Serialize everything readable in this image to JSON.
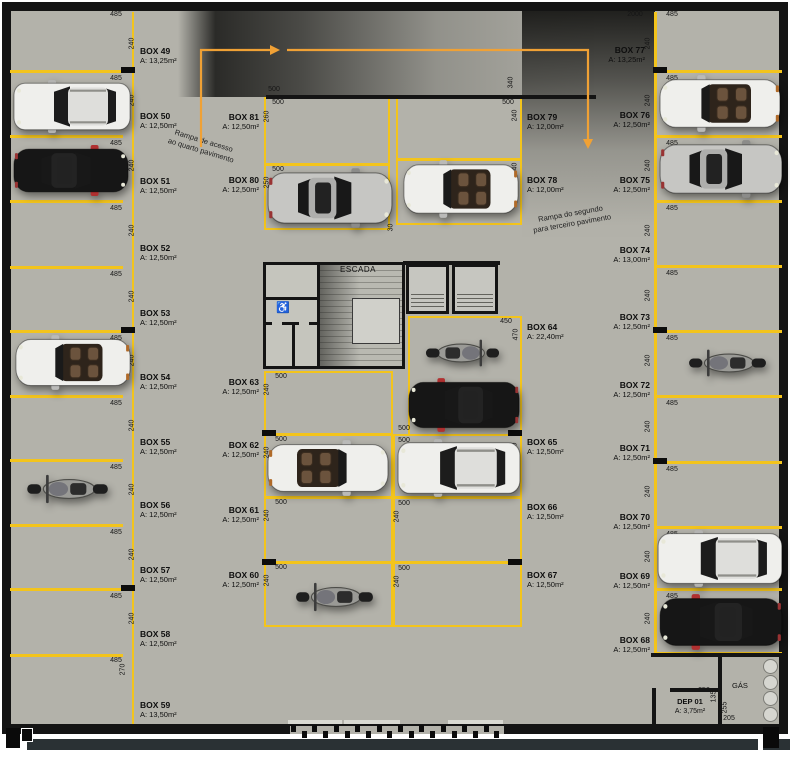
{
  "colors": {
    "floor": "#b3b2aa",
    "yellow": "#f3c41c",
    "wall": "#141414",
    "orange": "#f0a135",
    "strip": "#2a3134"
  },
  "rooms": {
    "escada": "ESCADA",
    "gas": "GÁS",
    "dep_name": "DEP 01",
    "dep_area": "A: 3,75m²"
  },
  "icons": {
    "wheelchair": "♿"
  },
  "annotations": [
    {
      "text": "Rampa de acesso",
      "line2": "ao quarto pavimento",
      "x": 168,
      "y": 136,
      "rot": 17
    },
    {
      "text": "Rampa do segundo",
      "line2": "para terceiro pavimento",
      "x": 532,
      "y": 209,
      "rot": -10
    }
  ],
  "boxes": [
    {
      "label": "BOX 49",
      "area": "A: 13,25m²",
      "x": 140,
      "y": 46,
      "align": "left"
    },
    {
      "label": "BOX 50",
      "area": "A: 12,50m²",
      "x": 140,
      "y": 111,
      "align": "left"
    },
    {
      "label": "BOX 51",
      "area": "A: 12,50m²",
      "x": 140,
      "y": 176,
      "align": "left"
    },
    {
      "label": "BOX 52",
      "area": "A: 12,50m²",
      "x": 140,
      "y": 243,
      "align": "left"
    },
    {
      "label": "BOX 53",
      "area": "A: 12,50m²",
      "x": 140,
      "y": 308,
      "align": "left"
    },
    {
      "label": "BOX 54",
      "area": "A: 12,50m²",
      "x": 140,
      "y": 372,
      "align": "left"
    },
    {
      "label": "BOX 55",
      "area": "A: 12,50m²",
      "x": 140,
      "y": 437,
      "align": "left"
    },
    {
      "label": "BOX 56",
      "area": "A: 12,50m²",
      "x": 140,
      "y": 500,
      "align": "left"
    },
    {
      "label": "BOX 57",
      "area": "A: 12,50m²",
      "x": 140,
      "y": 565,
      "align": "left"
    },
    {
      "label": "BOX 58",
      "area": "A: 12,50m²",
      "x": 140,
      "y": 629,
      "align": "left"
    },
    {
      "label": "BOX 59",
      "area": "A: 13,50m²",
      "x": 140,
      "y": 700,
      "align": "left"
    },
    {
      "label": "BOX 60",
      "area": "A: 12,50m²",
      "x": 259,
      "y": 570,
      "align": "right"
    },
    {
      "label": "BOX 61",
      "area": "A: 12,50m²",
      "x": 259,
      "y": 505,
      "align": "right"
    },
    {
      "label": "BOX 62",
      "area": "A: 12,50m²",
      "x": 259,
      "y": 440,
      "align": "right"
    },
    {
      "label": "BOX 63",
      "area": "A: 12,50m²",
      "x": 259,
      "y": 377,
      "align": "right"
    },
    {
      "label": "BOX 64",
      "area": "A: 22,40m²",
      "x": 527,
      "y": 322,
      "align": "left"
    },
    {
      "label": "BOX 65",
      "area": "A: 12,50m²",
      "x": 527,
      "y": 437,
      "align": "left"
    },
    {
      "label": "BOX 66",
      "area": "A: 12,50m²",
      "x": 527,
      "y": 502,
      "align": "left"
    },
    {
      "label": "BOX 67",
      "area": "A: 12,50m²",
      "x": 527,
      "y": 570,
      "align": "left"
    },
    {
      "label": "BOX 68",
      "area": "A: 12,50m²",
      "x": 650,
      "y": 635,
      "align": "right"
    },
    {
      "label": "BOX 69",
      "area": "A: 12,50m²",
      "x": 650,
      "y": 571,
      "align": "right"
    },
    {
      "label": "BOX 70",
      "area": "A: 12,50m²",
      "x": 650,
      "y": 512,
      "align": "right"
    },
    {
      "label": "BOX 71",
      "area": "A: 12,50m²",
      "x": 650,
      "y": 443,
      "align": "right"
    },
    {
      "label": "BOX 72",
      "area": "A: 12,50m²",
      "x": 650,
      "y": 380,
      "align": "right"
    },
    {
      "label": "BOX 73",
      "area": "A: 12,50m²",
      "x": 650,
      "y": 312,
      "align": "right"
    },
    {
      "label": "BOX 74",
      "area": "A: 13,00m²",
      "x": 650,
      "y": 245,
      "align": "right"
    },
    {
      "label": "BOX 75",
      "area": "A: 12,50m²",
      "x": 650,
      "y": 175,
      "align": "right"
    },
    {
      "label": "BOX 76",
      "area": "A: 12,50m²",
      "x": 650,
      "y": 110,
      "align": "right"
    },
    {
      "label": "BOX 77",
      "area": "A: 13,25m²",
      "x": 645,
      "y": 45,
      "align": "right"
    },
    {
      "label": "BOX 78",
      "area": "A: 12,00m²",
      "x": 527,
      "y": 175,
      "align": "left"
    },
    {
      "label": "BOX 79",
      "area": "A: 12,00m²",
      "x": 527,
      "y": 112,
      "align": "left"
    },
    {
      "label": "BOX 80",
      "area": "A: 12,50m²",
      "x": 259,
      "y": 175,
      "align": "right"
    },
    {
      "label": "BOX 81",
      "area": "A: 12,50m²",
      "x": 259,
      "y": 112,
      "align": "right"
    }
  ],
  "dims": [
    {
      "t": "485",
      "x": 116,
      "y": 15
    },
    {
      "t": "485",
      "x": 116,
      "y": 79
    },
    {
      "t": "485",
      "x": 116,
      "y": 144
    },
    {
      "t": "485",
      "x": 116,
      "y": 209
    },
    {
      "t": "485",
      "x": 116,
      "y": 275
    },
    {
      "t": "485",
      "x": 116,
      "y": 339
    },
    {
      "t": "485",
      "x": 116,
      "y": 404
    },
    {
      "t": "485",
      "x": 116,
      "y": 468
    },
    {
      "t": "485",
      "x": 116,
      "y": 533
    },
    {
      "t": "485",
      "x": 116,
      "y": 597
    },
    {
      "t": "485",
      "x": 116,
      "y": 661
    },
    {
      "t": "240",
      "x": 132,
      "y": 44,
      "r": 1
    },
    {
      "t": "240",
      "x": 132,
      "y": 101,
      "r": 1
    },
    {
      "t": "240",
      "x": 132,
      "y": 166,
      "r": 1
    },
    {
      "t": "240",
      "x": 132,
      "y": 231,
      "r": 1
    },
    {
      "t": "240",
      "x": 132,
      "y": 297,
      "r": 1
    },
    {
      "t": "240",
      "x": 132,
      "y": 361,
      "r": 1
    },
    {
      "t": "240",
      "x": 132,
      "y": 426,
      "r": 1
    },
    {
      "t": "240",
      "x": 132,
      "y": 490,
      "r": 1
    },
    {
      "t": "240",
      "x": 132,
      "y": 555,
      "r": 1
    },
    {
      "t": "240",
      "x": 132,
      "y": 619,
      "r": 1
    },
    {
      "t": "270",
      "x": 123,
      "y": 670,
      "r": 1
    },
    {
      "t": "485",
      "x": 672,
      "y": 15
    },
    {
      "t": "485",
      "x": 672,
      "y": 79
    },
    {
      "t": "485",
      "x": 672,
      "y": 144
    },
    {
      "t": "485",
      "x": 672,
      "y": 209
    },
    {
      "t": "485",
      "x": 672,
      "y": 274
    },
    {
      "t": "485",
      "x": 672,
      "y": 339
    },
    {
      "t": "485",
      "x": 672,
      "y": 404
    },
    {
      "t": "485",
      "x": 672,
      "y": 470
    },
    {
      "t": "485",
      "x": 672,
      "y": 535
    },
    {
      "t": "485",
      "x": 672,
      "y": 597
    },
    {
      "t": "240",
      "x": 648,
      "y": 44,
      "r": 1
    },
    {
      "t": "240",
      "x": 648,
      "y": 101,
      "r": 1
    },
    {
      "t": "240",
      "x": 648,
      "y": 166,
      "r": 1
    },
    {
      "t": "240",
      "x": 648,
      "y": 231,
      "r": 1
    },
    {
      "t": "240",
      "x": 648,
      "y": 296,
      "r": 1
    },
    {
      "t": "240",
      "x": 648,
      "y": 361,
      "r": 1
    },
    {
      "t": "240",
      "x": 648,
      "y": 427,
      "r": 1
    },
    {
      "t": "240",
      "x": 648,
      "y": 492,
      "r": 1
    },
    {
      "t": "240",
      "x": 648,
      "y": 557,
      "r": 1
    },
    {
      "t": "240",
      "x": 648,
      "y": 619,
      "r": 1
    },
    {
      "t": "2000",
      "x": 635,
      "y": 15
    },
    {
      "t": "500",
      "x": 274,
      "y": 90
    },
    {
      "t": "340",
      "x": 511,
      "y": 83,
      "r": 1
    },
    {
      "t": "500",
      "x": 278,
      "y": 103
    },
    {
      "t": "260",
      "x": 267,
      "y": 117,
      "r": 1
    },
    {
      "t": "500",
      "x": 508,
      "y": 103
    },
    {
      "t": "240",
      "x": 515,
      "y": 116,
      "r": 1
    },
    {
      "t": "500",
      "x": 278,
      "y": 170
    },
    {
      "t": "250",
      "x": 267,
      "y": 183,
      "r": 1
    },
    {
      "t": "240",
      "x": 515,
      "y": 169,
      "r": 1
    },
    {
      "t": "30",
      "x": 391,
      "y": 228,
      "r": 1
    },
    {
      "t": "450",
      "x": 506,
      "y": 322
    },
    {
      "t": "470",
      "x": 516,
      "y": 335,
      "r": 1
    },
    {
      "t": "500",
      "x": 281,
      "y": 377
    },
    {
      "t": "240",
      "x": 267,
      "y": 390,
      "r": 1
    },
    {
      "t": "500",
      "x": 281,
      "y": 440
    },
    {
      "t": "240",
      "x": 267,
      "y": 453,
      "r": 1
    },
    {
      "t": "500",
      "x": 281,
      "y": 503
    },
    {
      "t": "240",
      "x": 267,
      "y": 516,
      "r": 1
    },
    {
      "t": "500",
      "x": 281,
      "y": 568
    },
    {
      "t": "240",
      "x": 267,
      "y": 581,
      "r": 1
    },
    {
      "t": "500",
      "x": 404,
      "y": 429
    },
    {
      "t": "500",
      "x": 404,
      "y": 441
    },
    {
      "t": "240",
      "x": 515,
      "y": 449,
      "r": 1
    },
    {
      "t": "500",
      "x": 404,
      "y": 504
    },
    {
      "t": "240",
      "x": 397,
      "y": 517,
      "r": 1
    },
    {
      "t": "500",
      "x": 404,
      "y": 569
    },
    {
      "t": "240",
      "x": 397,
      "y": 582,
      "r": 1
    },
    {
      "t": "250",
      "x": 704,
      "y": 691
    },
    {
      "t": "135",
      "x": 714,
      "y": 697,
      "r": 1
    },
    {
      "t": "255",
      "x": 725,
      "y": 708,
      "r": 1
    },
    {
      "t": "205",
      "x": 729,
      "y": 719
    }
  ],
  "cars": [
    {
      "type": "suv",
      "body": "#efefec",
      "x": 12,
      "y": 79,
      "w": 120,
      "h": 55,
      "flip": true
    },
    {
      "type": "sedan",
      "body": "#161616",
      "x": 12,
      "y": 144,
      "w": 118,
      "h": 53,
      "flip": false,
      "accent": "#b03030"
    },
    {
      "type": "convertible",
      "body": "#efefec",
      "x": 14,
      "y": 334,
      "w": 118,
      "h": 57,
      "flip": true
    },
    {
      "type": "moto",
      "x": 24,
      "y": 469,
      "w": 86,
      "h": 40,
      "flip": true
    },
    {
      "type": "sedan",
      "body": "#c6c6c3",
      "x": 266,
      "y": 167,
      "w": 128,
      "h": 62,
      "flip": false
    },
    {
      "type": "convertible",
      "body": "#efefec",
      "x": 402,
      "y": 159,
      "w": 118,
      "h": 60,
      "flip": true
    },
    {
      "type": "moto",
      "x": 424,
      "y": 334,
      "w": 78,
      "h": 38,
      "flip": false
    },
    {
      "type": "sedan",
      "body": "#161616",
      "x": 407,
      "y": 377,
      "w": 114,
      "h": 56,
      "flip": true,
      "accent": "#b03030"
    },
    {
      "type": "convertible",
      "body": "#efefec",
      "x": 266,
      "y": 439,
      "w": 124,
      "h": 58,
      "flip": false
    },
    {
      "type": "suv",
      "body": "#efefec",
      "x": 396,
      "y": 438,
      "w": 126,
      "h": 60,
      "flip": true
    },
    {
      "type": "moto",
      "x": 293,
      "y": 577,
      "w": 82,
      "h": 40,
      "flip": true
    },
    {
      "type": "convertible",
      "body": "#efefec",
      "x": 658,
      "y": 74,
      "w": 124,
      "h": 59,
      "flip": true
    },
    {
      "type": "sedan",
      "body": "#c6c6c3",
      "x": 658,
      "y": 139,
      "w": 126,
      "h": 60,
      "flip": false
    },
    {
      "type": "moto",
      "x": 686,
      "y": 344,
      "w": 82,
      "h": 38,
      "flip": true
    },
    {
      "type": "suv",
      "body": "#efefec",
      "x": 656,
      "y": 529,
      "w": 128,
      "h": 59,
      "flip": true
    },
    {
      "type": "sedan",
      "body": "#161616",
      "x": 658,
      "y": 593,
      "w": 126,
      "h": 58,
      "flip": true,
      "accent": "#b03030"
    }
  ]
}
